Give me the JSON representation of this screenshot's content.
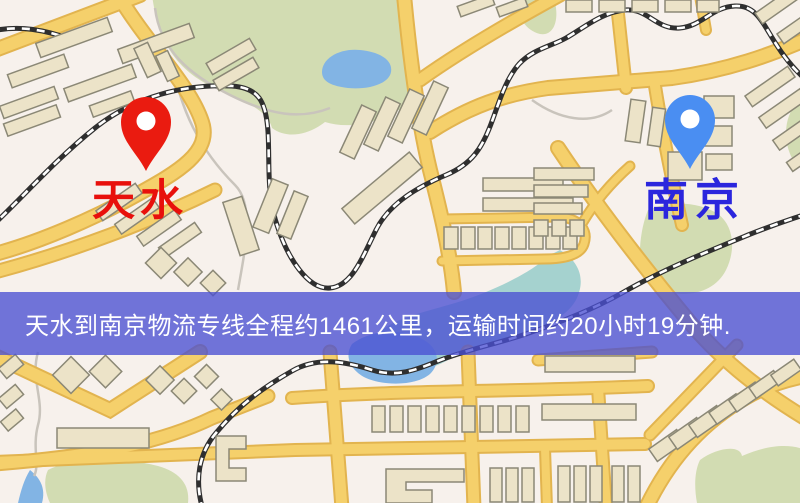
{
  "banner": {
    "text": "天水到南京物流专线全程约1461公里，运输时间约20小时19分钟.",
    "background_color": "#4a50d2",
    "text_color": "#ffffff"
  },
  "markers": {
    "origin": {
      "label": "天水",
      "label_color": "#e8100c",
      "pin_color": "#ea1b10",
      "pin_icon": "red-location-pin"
    },
    "destination": {
      "label": "南京",
      "label_color": "#2b26dd",
      "pin_color": "#4a8ef2",
      "pin_icon": "blue-location-pin"
    }
  },
  "map": {
    "theme_colors": {
      "background": "#f7f1ec",
      "road_fill": "#f5d06b",
      "road_casing": "#e2b44f",
      "park": "#d2dcb2",
      "water": "#82b4e4",
      "water_teal": "#a5d2cf",
      "building_fill": "#ece3c8",
      "building_outline": "#8b8876",
      "railway": "#2f2f2f"
    }
  }
}
